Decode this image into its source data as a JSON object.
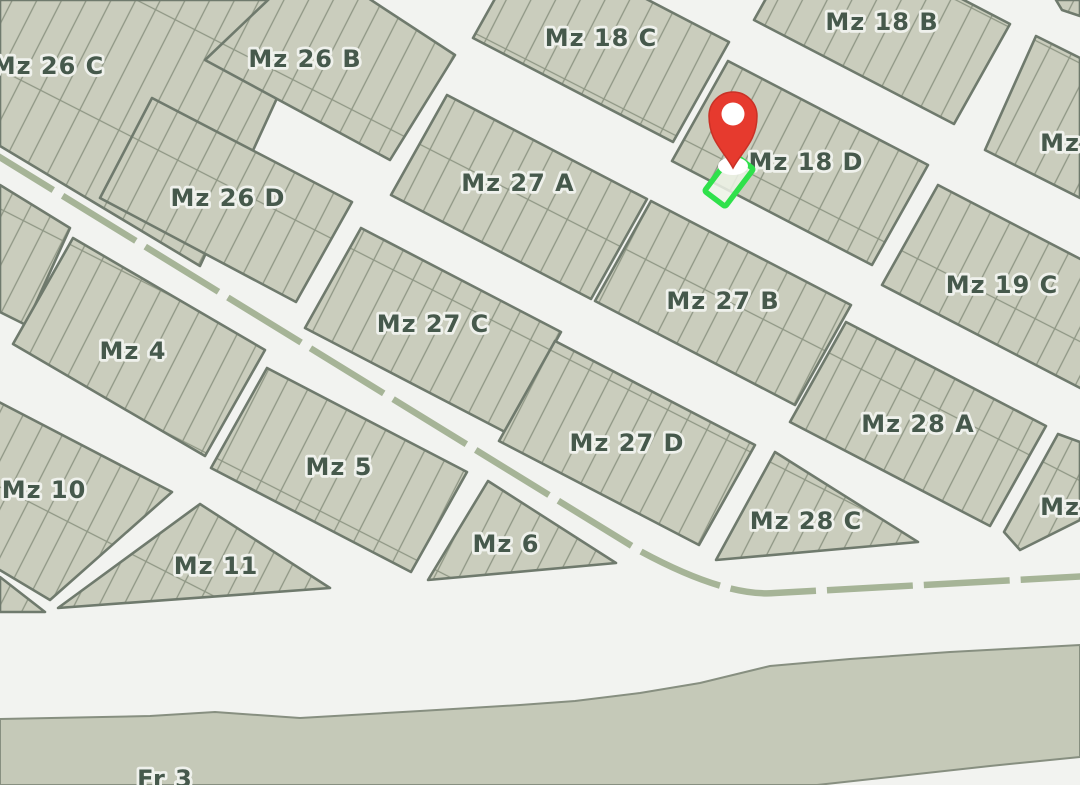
{
  "map": {
    "type": "cadastral-parcel-map",
    "colors": {
      "street_background": "#f2f3f0",
      "block_fill": "#cacdbd",
      "river_fill": "#c5c9b8",
      "river_border": "#878f80",
      "lot_line": "#8e9684",
      "block_border": "#6f7a6d",
      "label_text": "#46594c",
      "label_halo": "#eff1ec",
      "avenue_dash": "#a6b497",
      "marker_red": "#e63a2e",
      "marker_red_edge": "#c93126",
      "marker_hole": "#ffffff",
      "highlight_green": "#2fe14b",
      "highlight_fill": "#eef3e8"
    },
    "labels": [
      {
        "id": "mz-26-c",
        "text": "Mz 26 C",
        "x": 48,
        "y": 66
      },
      {
        "id": "mz-26-b",
        "text": "Mz 26 B",
        "x": 305,
        "y": 59
      },
      {
        "id": "mz-18-c",
        "text": "Mz 18 C",
        "x": 601,
        "y": 38
      },
      {
        "id": "mz-18-b",
        "text": "Mz 18 B",
        "x": 882,
        "y": 22
      },
      {
        "id": "mz-26-d",
        "text": "Mz 26 D",
        "x": 228,
        "y": 198
      },
      {
        "id": "mz-27-a",
        "text": "Mz 27 A",
        "x": 518,
        "y": 183
      },
      {
        "id": "mz-18-d",
        "text": "Mz 18 D",
        "x": 806,
        "y": 162
      },
      {
        "id": "mz-right-top",
        "text": "Mz",
        "x": 1060,
        "y": 143
      },
      {
        "id": "mz-27-c",
        "text": "Mz 27 C",
        "x": 433,
        "y": 324
      },
      {
        "id": "mz-27-b",
        "text": "Mz 27 B",
        "x": 723,
        "y": 301
      },
      {
        "id": "mz-19-c",
        "text": "Mz 19 C",
        "x": 1002,
        "y": 285
      },
      {
        "id": "mz-4",
        "text": "Mz 4",
        "x": 133,
        "y": 351
      },
      {
        "id": "mz-28-a",
        "text": "Mz 28 A",
        "x": 918,
        "y": 424
      },
      {
        "id": "mz-10",
        "text": "Mz 10",
        "x": 44,
        "y": 490
      },
      {
        "id": "mz-5",
        "text": "Mz 5",
        "x": 339,
        "y": 467
      },
      {
        "id": "mz-27-d",
        "text": "Mz 27 D",
        "x": 627,
        "y": 443
      },
      {
        "id": "mz-28-c",
        "text": "Mz 28 C",
        "x": 806,
        "y": 521
      },
      {
        "id": "mz-right-bottom",
        "text": "Mz",
        "x": 1060,
        "y": 507
      },
      {
        "id": "mz-11",
        "text": "Mz 11",
        "x": 216,
        "y": 566
      },
      {
        "id": "mz-6",
        "text": "Mz 6",
        "x": 506,
        "y": 544
      },
      {
        "id": "fr-3",
        "text": "Fr 3",
        "x": 165,
        "y": 779
      }
    ],
    "blocks": [
      {
        "id": "mz-26-c",
        "points": "0,0 322,0 200,266 0,146"
      },
      {
        "id": "sliver-left",
        "points": "0,185 70,228 26,325 0,312"
      },
      {
        "id": "mz-26-b",
        "points": "310,-40 455,55 390,160 205,60"
      },
      {
        "id": "mz-18-c",
        "points": "529,-62 729,42 673,142 473,38"
      },
      {
        "id": "mz-18-b",
        "points": "810,-80 1010,24 954,124 754,20"
      },
      {
        "id": "corner-top-right",
        "points": "1056,0 1080,0 1080,16 1062,10"
      },
      {
        "id": "mz-right-top",
        "points": "1036,36 1080,58 1080,198 985,150"
      },
      {
        "id": "mz-26-d",
        "points": "152,98 352,202 296,302 100,198"
      },
      {
        "id": "mz-27-a",
        "points": "447,95 647,199 591,299 391,195"
      },
      {
        "id": "mz-18-d",
        "points": "728,61 928,165 872,265 672,161"
      },
      {
        "id": "mz-19-c",
        "points": "938,185 1138,289 1082,389 882,285"
      },
      {
        "id": "mz-27-c",
        "points": "361,228 561,332 505,432 305,328"
      },
      {
        "id": "mz-27-b",
        "points": "651,201 851,305 795,405 595,301"
      },
      {
        "id": "mz-28-a",
        "points": "846,322 1046,426 990,526 790,422"
      },
      {
        "id": "mz-27-d",
        "points": "555,341 755,445 699,545 499,441"
      },
      {
        "id": "mz-4",
        "points": "73,238 265,350 205,456 13,344"
      },
      {
        "id": "mz-5",
        "points": "267,368 467,472 411,572 211,468"
      },
      {
        "id": "mz-10",
        "points": "-28,388 172,492 50,600 -84,520"
      },
      {
        "id": "mz-11",
        "points": "200,504 330,588 58,608"
      },
      {
        "id": "mz-6",
        "points": "488,481 616,563 428,580"
      },
      {
        "id": "mz-28-c",
        "points": "775,452 918,542 716,560"
      },
      {
        "id": "sliver-left-bottom",
        "points": "0,577 45,612 0,612"
      },
      {
        "id": "mz-right-bottom",
        "points": "1004,532 1058,434 1080,442 1080,520 1020,550"
      }
    ],
    "river": {
      "id": "fr-3",
      "points": "0,719 150,716 215,712 300,718 420,711 520,705 575,701 640,693 700,683 770,666 850,659 950,652 1080,645 1080,757 990,766 817,785 0,785"
    },
    "avenue": {
      "path": "M -20 145 L 640 551 Q 725 597 775 593 L 1090 576",
      "dash_array": "86 11",
      "width": 6.5
    },
    "marker": {
      "pin_path": "M 733 168 C 724 151 709 141 709 116 A 24 24 0 1 1 757 116 C 757 141 742 151 733 168 Z",
      "hole_cx": 733,
      "hole_cy": 114,
      "hole_r": 11.5,
      "base_cx": 733,
      "base_cy": 166,
      "base_rx": 15,
      "base_ry": 9
    },
    "highlight": {
      "cx": 729,
      "cy": 180,
      "rot": 37,
      "w": 26,
      "h": 47,
      "stroke_width": 5.5,
      "fill_opacity": 0.85
    },
    "lot_pattern": {
      "tile_w": 22,
      "tile_h": 124,
      "angle": 27,
      "line_width": 1.3
    }
  }
}
